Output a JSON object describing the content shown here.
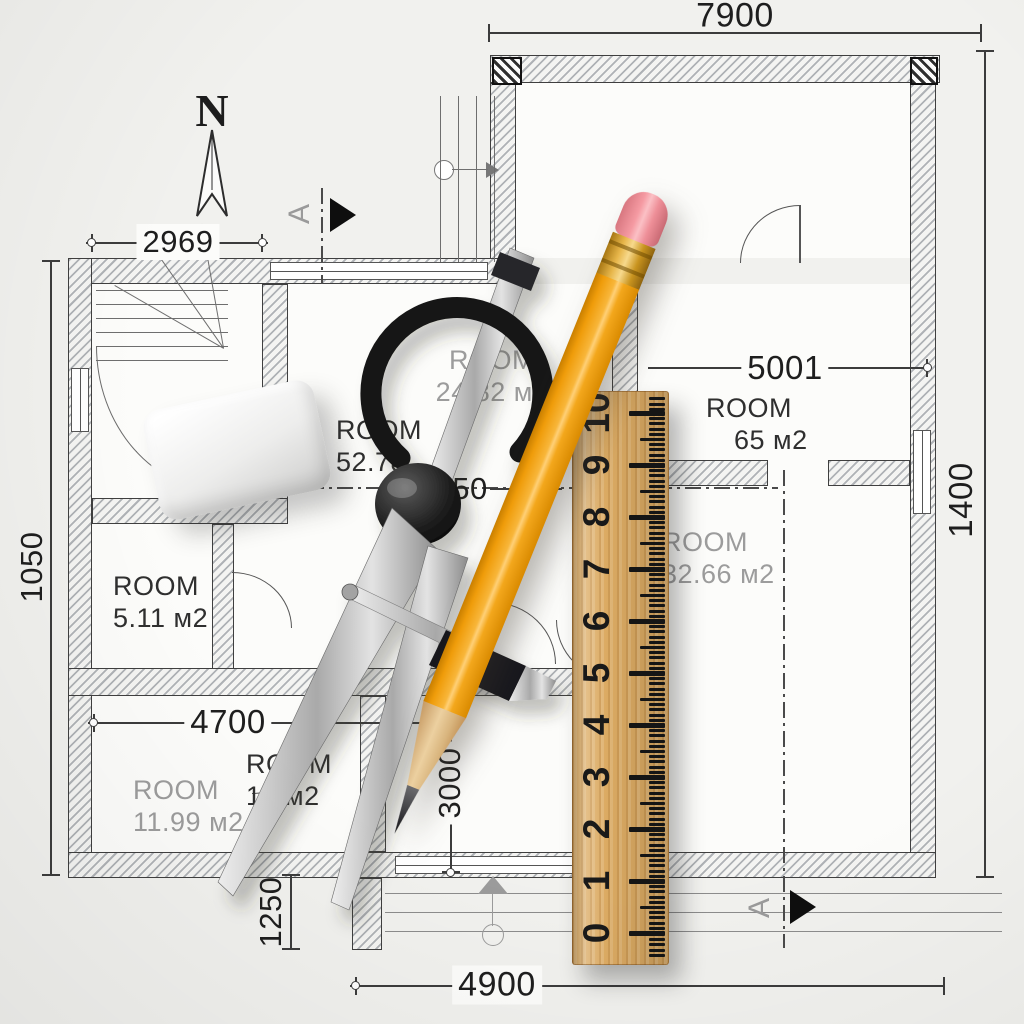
{
  "title": "Architectural floor plan with drafting tools",
  "north": {
    "label": "N"
  },
  "section_markers": {
    "top": "A",
    "bottom": "A"
  },
  "dims": {
    "top_width": "7900",
    "upper_left": "2969",
    "right_room": "5001",
    "right_side": "1400",
    "left_side": "1050",
    "middle_width": "4700",
    "middle_height": "3000",
    "lower_left": "1250",
    "bottom_width": "4900",
    "partial": "50"
  },
  "rooms": [
    {
      "name": "ROOM",
      "area": "24.82 м2"
    },
    {
      "name": "ROOM",
      "area": "52.78"
    },
    {
      "name": "ROOM",
      "area": "65 м2"
    },
    {
      "name": "ROOM",
      "area": "32.66 м2"
    },
    {
      "name": "ROOM",
      "area": "5.11 м2"
    },
    {
      "name": "ROOM",
      "area": "12 м2"
    },
    {
      "name": "ROOM",
      "area": "11.99 м2"
    }
  ],
  "ruler": {
    "numbers": [
      "10",
      "9",
      "8",
      "7",
      "6",
      "5",
      "4",
      "3",
      "2",
      "1",
      "0"
    ]
  },
  "colors": {
    "pencil_body": "#f1a01b",
    "pencil_eraser": "#ee8f98",
    "ferrule_gold": "#d7a227",
    "ruler_wood": "#dcab63",
    "compass_dark": "#1a1a1a",
    "metal": "#b9bcc0",
    "wall_outline": "#3f3f3f",
    "dim_text": "#212121",
    "room_text_gray": "#9c9c9c"
  }
}
